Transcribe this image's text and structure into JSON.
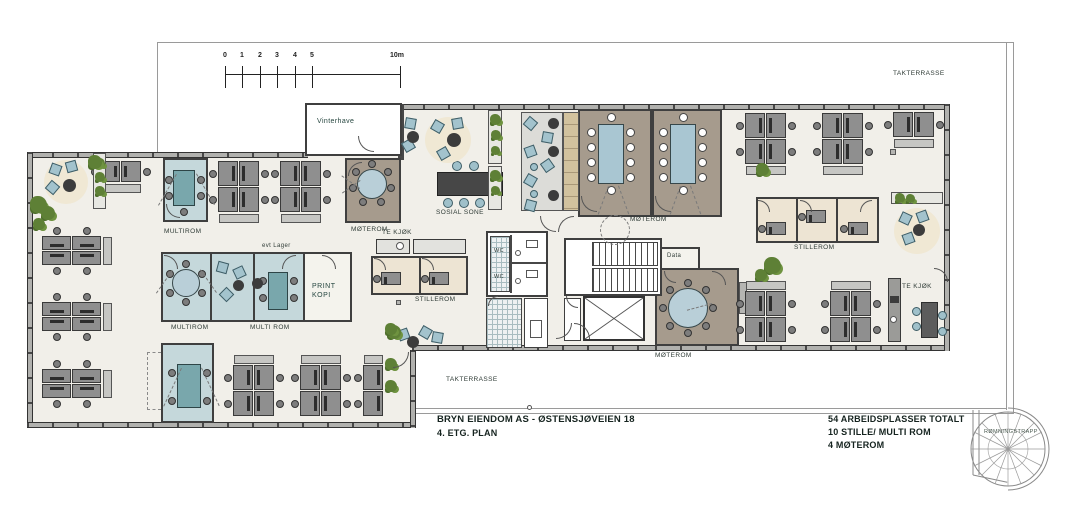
{
  "title_block": {
    "line1": "BRYN EIENDOM AS  -  ØSTENSJØVEIEN 18",
    "line2": "4. ETG. PLAN"
  },
  "summary": {
    "line1": "54 ARBEIDSPLASSER TOTALT",
    "line2": "10 STILLE/ MULTI ROM",
    "line3": "4 MØTEROM"
  },
  "scale_bar": {
    "ticks": [
      "0",
      "1",
      "2",
      "3",
      "4",
      "5"
    ],
    "end_label": "10m"
  },
  "rooms": {
    "takterrasse_top": "TAKTERRASSE",
    "takterrasse_bottom": "TAKTERRASSE",
    "vinterhave": "Vinterhave",
    "multirom_top": "MULTIROM",
    "moterom_top_left": "MØTEROM",
    "te_kjok_left": "TE KJØK",
    "evt_lager": "evt Lager",
    "stillerom_left": "STILLEROM",
    "multirom_mid_1": "MULTIROM",
    "multirom_mid_2": "MULTI ROM",
    "print_line1": "PRINT",
    "print_line2": "KOPI",
    "sosial_sone": "SOSIAL SONE",
    "moterom_center": "MØTEROM",
    "wc_1": "WC",
    "wc_2": "WC",
    "data_room": "Data",
    "moterom_south": "MØTEROM",
    "stillerom_right": "STILLEROM",
    "te_kjok_right": "TE KJØK",
    "romningstrapp": "RØMNINGSTRAPP"
  },
  "colors": {
    "floor": "#f1efe9",
    "wall": "#474747",
    "meeting_room": "#a69b8d",
    "multi_room": "#c5d8db",
    "stille_room": "#ede4d3",
    "table_blue": "#a9c6d2",
    "plant_green": "#5e8036",
    "label_text": "#2f3b36"
  }
}
